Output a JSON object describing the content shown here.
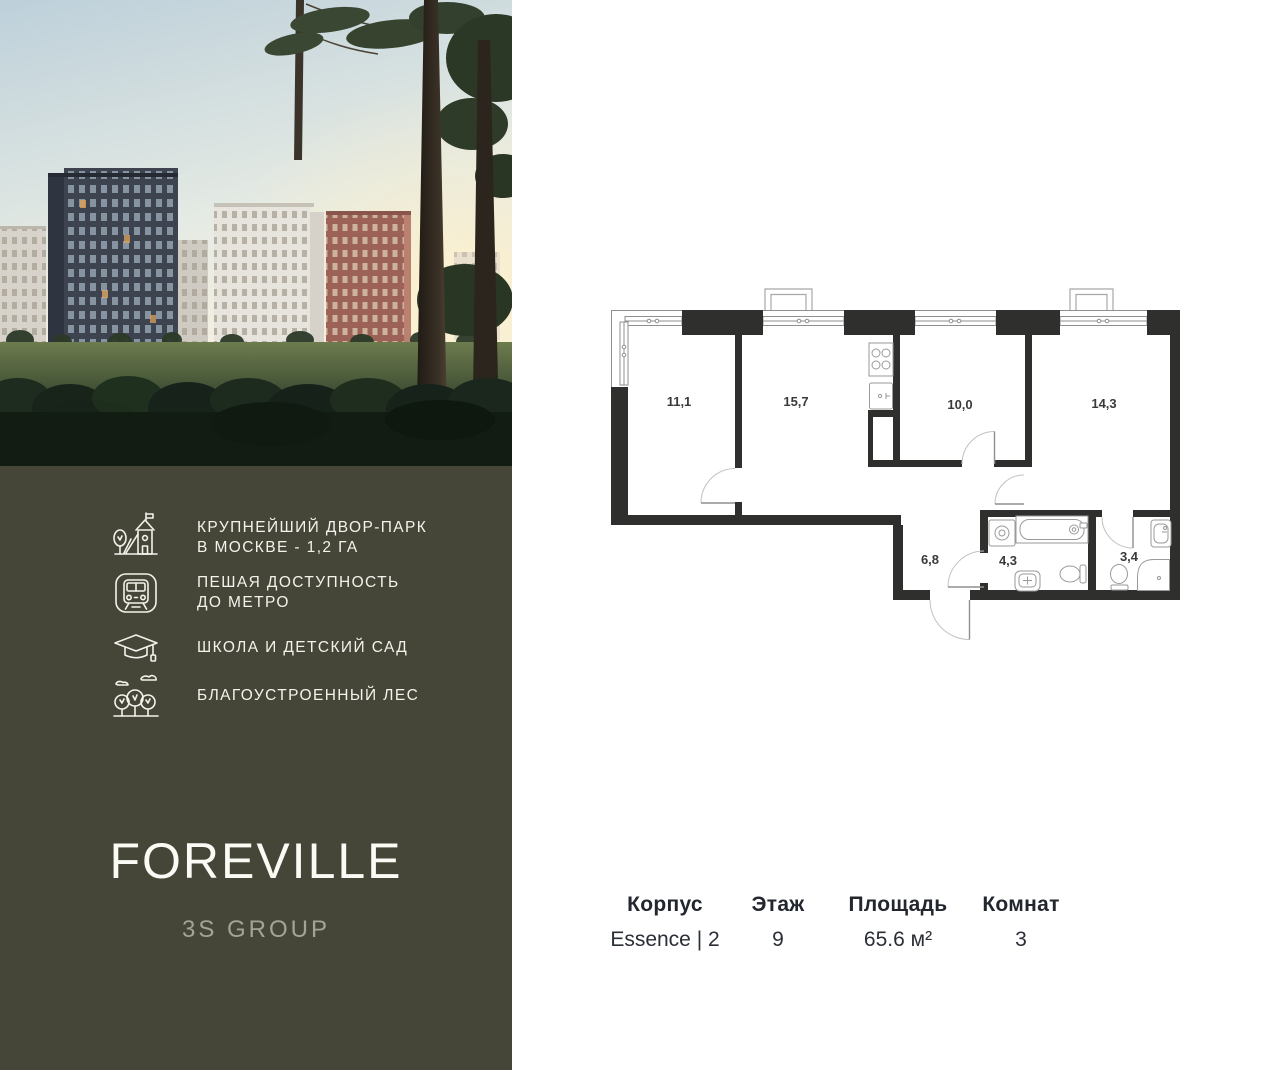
{
  "sidebar": {
    "photo_alt": "residential-buildings-at-sunset",
    "features": [
      {
        "icon": "playground-icon",
        "text": "КРУПНЕЙШИЙ ДВОР-ПАРК\nВ МОСКВЕ - 1,2 ГА"
      },
      {
        "icon": "metro-icon",
        "text": "ПЕШАЯ ДОСТУПНОСТЬ\nДО МЕТРО"
      },
      {
        "icon": "graduation-cap-icon",
        "text": "ШКОЛА И ДЕТСКИЙ САД"
      },
      {
        "icon": "forest-icon",
        "text": "БЛАГОУСТРОЕННЫЙ ЛЕС"
      }
    ],
    "logo": "FOREVILLE",
    "brand": "3S GROUP"
  },
  "floorplan": {
    "rooms": [
      {
        "id": "room-1",
        "area": "11,1"
      },
      {
        "id": "room-2",
        "area": "15,7"
      },
      {
        "id": "room-3",
        "area": "10,0"
      },
      {
        "id": "room-4",
        "area": "14,3"
      },
      {
        "id": "hallway",
        "area": "6,8"
      },
      {
        "id": "bathroom",
        "area": "4,3"
      },
      {
        "id": "wc",
        "area": "3,4"
      }
    ]
  },
  "details": {
    "columns": [
      {
        "label": "Корпус",
        "value": "Essence | 2"
      },
      {
        "label": "Этаж",
        "value": "9"
      },
      {
        "label": "Площадь",
        "value": "65.6 м²"
      },
      {
        "label": "Комнат",
        "value": "3"
      }
    ]
  },
  "colors": {
    "sidebar_bg": "#464638",
    "wall": "#2f2f2d",
    "text_dark": "#22262e"
  }
}
